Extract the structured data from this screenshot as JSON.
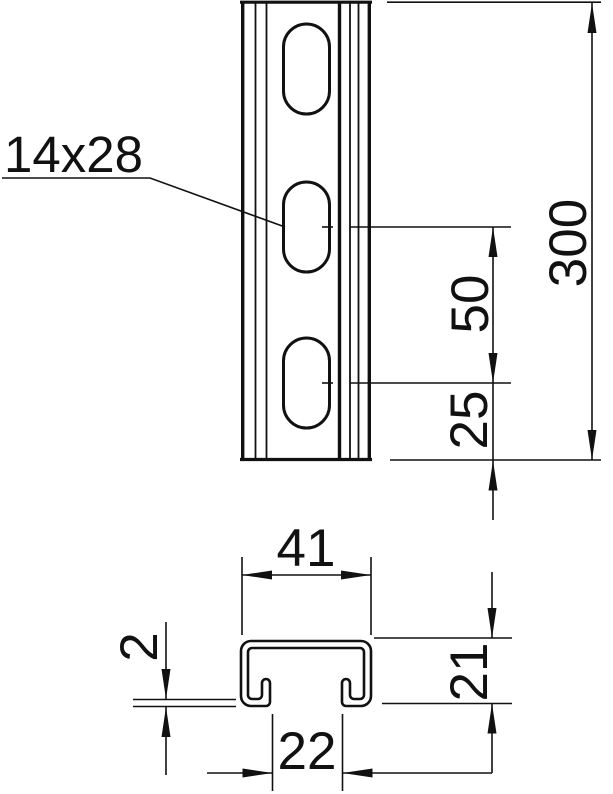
{
  "drawing_type": "technical-dimension-drawing",
  "colors": {
    "line": "#111111",
    "background": "#ffffff"
  },
  "front_view": {
    "slot_label": "14x28",
    "dim_length": "300",
    "dim_slot_spacing": "50",
    "dim_slot_end_offset": "25"
  },
  "cross_section": {
    "dim_width": "41",
    "dim_height": "21",
    "dim_opening": "22",
    "dim_thickness": "2"
  }
}
